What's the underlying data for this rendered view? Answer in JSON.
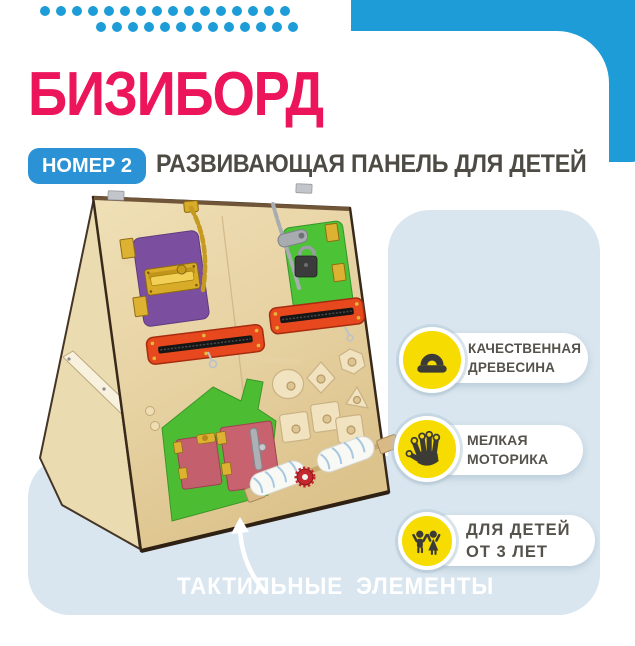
{
  "header": {
    "title": "БИЗИБОРД",
    "badge": "НОМЕР 2",
    "subtitle": "РАЗВИВАЮЩАЯ ПАНЕЛЬ ДЛЯ ДЕТЕЙ"
  },
  "features": [
    {
      "icon": "wood-plane-icon",
      "line1": "КАЧЕСТВЕННАЯ",
      "line2": "ДРЕВЕСИНА"
    },
    {
      "icon": "hand-icon",
      "line1": "МЕЛКАЯ",
      "line2": "МОТОРИКА"
    },
    {
      "icon": "children-icon",
      "line1": "ДЛЯ ДЕТЕЙ",
      "line2": "ОТ 3 ЛЕТ"
    }
  ],
  "caption": {
    "word1": "ТАКТИЛЬНЫЕ",
    "word2": "ЭЛЕМЕНТЫ"
  },
  "decor": {
    "dots_row1": 16,
    "dots_row2": 13
  },
  "colors": {
    "accent_pink": "#EC155B",
    "brand_blue": "#1E9CD8",
    "badge_blue": "#2B92D5",
    "panel_blue": "#D9E6EF",
    "icon_yellow": "#F6DC00",
    "text_dark": "#4E4B45",
    "callout_text": "#55524B"
  }
}
